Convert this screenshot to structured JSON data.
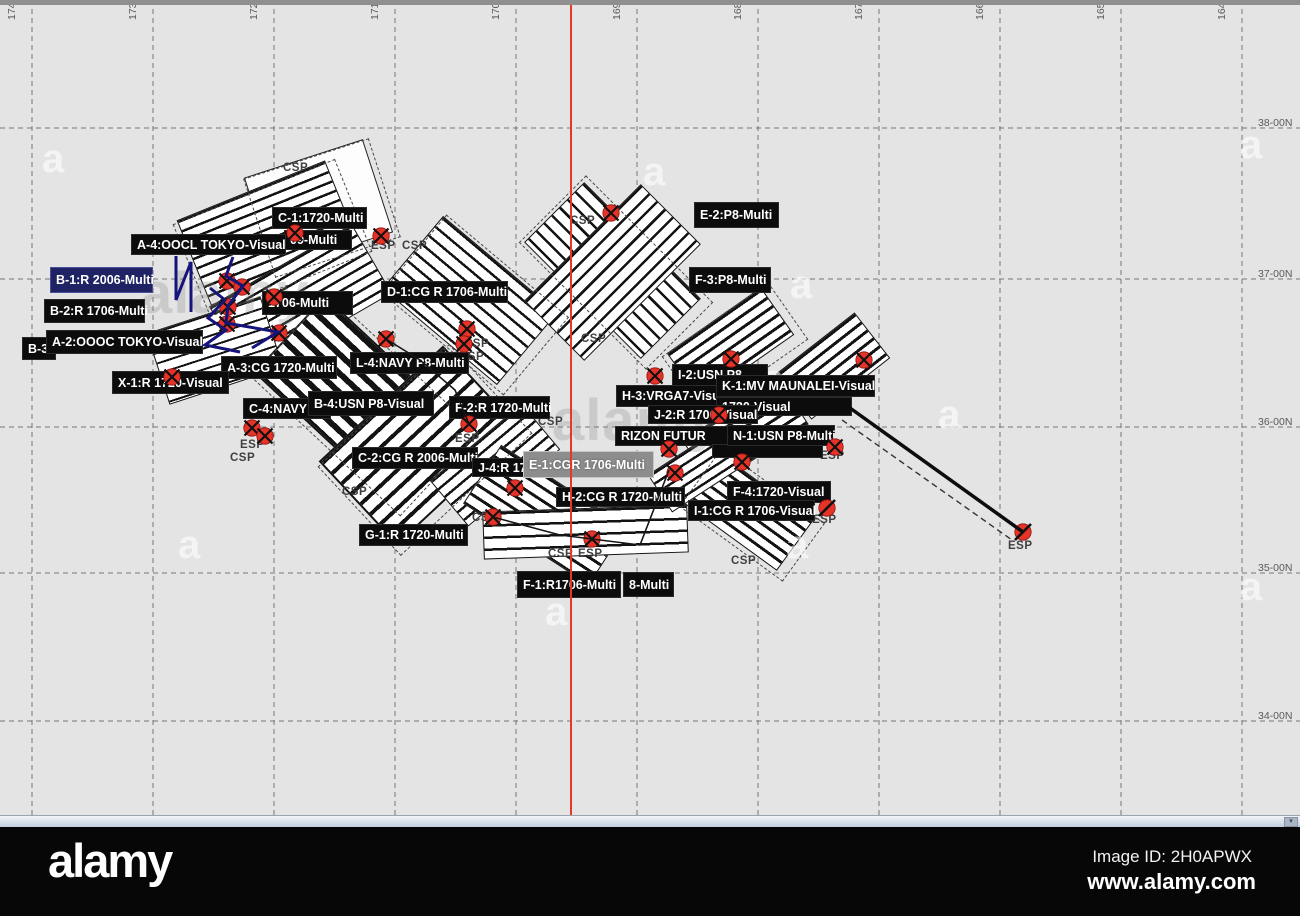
{
  "map": {
    "background": "#e4e4e4",
    "red_line_x": 570,
    "grid": {
      "lon_labels": [
        {
          "text": "174-00W",
          "x": 32
        },
        {
          "text": "173-00W",
          "x": 153
        },
        {
          "text": "172-00W",
          "x": 274
        },
        {
          "text": "171-00W",
          "x": 395
        },
        {
          "text": "170-00W",
          "x": 516
        },
        {
          "text": "169-00W",
          "x": 637
        },
        {
          "text": "168-00W",
          "x": 758
        },
        {
          "text": "167-00W",
          "x": 879
        },
        {
          "text": "166-00W",
          "x": 1000
        },
        {
          "text": "165-00W",
          "x": 1121
        },
        {
          "text": "164-00W",
          "x": 1242
        }
      ],
      "lat_labels": [
        {
          "text": "38-00N",
          "y": 133
        },
        {
          "text": "37-00N",
          "y": 284
        },
        {
          "text": "36-00N",
          "y": 432
        },
        {
          "text": "35-00N",
          "y": 578
        },
        {
          "text": "34-00N",
          "y": 726
        }
      ]
    },
    "search_area_labels": [
      {
        "text": "C-1:1720-Multi",
        "x": 272,
        "y": 207,
        "w": 95,
        "h": 22,
        "bg": "black"
      },
      {
        "text": "09-Multi",
        "x": 284,
        "y": 230,
        "w": 68,
        "h": 20,
        "bg": "black"
      },
      {
        "text": "A-4:OOCL TOKYO-Visual",
        "x": 131,
        "y": 234,
        "w": 155,
        "h": 21,
        "bg": "black"
      },
      {
        "text": "B-1:R 2006-Multi",
        "x": 50,
        "y": 267,
        "w": 103,
        "h": 26,
        "bg": "navy"
      },
      {
        "text": "B-2:R 1706-Multi",
        "x": 44,
        "y": 299,
        "w": 101,
        "h": 24,
        "bg": "black"
      },
      {
        "text": "1706-Multi",
        "x": 262,
        "y": 291,
        "w": 91,
        "h": 24,
        "bg": "black"
      },
      {
        "text": "B-3",
        "x": 22,
        "y": 337,
        "w": 34,
        "h": 23,
        "bg": "black"
      },
      {
        "text": "A-2:OOOC TOKYO-Visual",
        "x": 46,
        "y": 330,
        "w": 157,
        "h": 24,
        "bg": "black"
      },
      {
        "text": "A-3:CG 1720-Multi",
        "x": 221,
        "y": 356,
        "w": 116,
        "h": 23,
        "bg": "black"
      },
      {
        "text": "X-1:R 1720-Visual",
        "x": 112,
        "y": 371,
        "w": 117,
        "h": 23,
        "bg": "black"
      },
      {
        "text": "C-4:NAVY",
        "x": 243,
        "y": 398,
        "w": 88,
        "h": 21,
        "bg": "black"
      },
      {
        "text": "B-4:USN P8-Visual",
        "x": 308,
        "y": 391,
        "w": 126,
        "h": 25,
        "bg": "black"
      },
      {
        "text": "L-4:NAVY P8-Multi",
        "x": 350,
        "y": 352,
        "w": 119,
        "h": 22,
        "bg": "black"
      },
      {
        "text": "D-1:CG R 1706-Multi",
        "x": 381,
        "y": 281,
        "w": 127,
        "h": 22,
        "bg": "black"
      },
      {
        "text": "F-2:R 1720-Multi",
        "x": 449,
        "y": 396,
        "w": 101,
        "h": 23,
        "bg": "black"
      },
      {
        "text": "C-2:CG R 2006-Multi",
        "x": 352,
        "y": 447,
        "w": 126,
        "h": 22,
        "bg": "black"
      },
      {
        "text": "J-4:R 170",
        "x": 472,
        "y": 458,
        "w": 60,
        "h": 19,
        "bg": "black"
      },
      {
        "text": "E-1:CGR 1706-Multi",
        "x": 523,
        "y": 451,
        "w": 131,
        "h": 27,
        "bg": "gray"
      },
      {
        "text": "H-2:CG R 1720-Multi",
        "x": 556,
        "y": 487,
        "w": 129,
        "h": 20,
        "bg": "black"
      },
      {
        "text": "G-1:R 1720-Multi",
        "x": 359,
        "y": 524,
        "w": 109,
        "h": 22,
        "bg": "black"
      },
      {
        "text": "F-1:R1706-Multi",
        "x": 517,
        "y": 571,
        "w": 104,
        "h": 27,
        "bg": "black"
      },
      {
        "text": "8-Multi",
        "x": 623,
        "y": 572,
        "w": 51,
        "h": 25,
        "bg": "black"
      },
      {
        "text": "E-2:P8-Multi",
        "x": 694,
        "y": 202,
        "w": 85,
        "h": 26,
        "bg": "black"
      },
      {
        "text": "F-3:P8-Multi",
        "x": 689,
        "y": 267,
        "w": 82,
        "h": 26,
        "bg": "black"
      },
      {
        "text": "I-2:USN P8",
        "x": 672,
        "y": 364,
        "w": 96,
        "h": 22,
        "bg": "black"
      },
      {
        "text": "H-3:VRGA7-Visual",
        "x": 616,
        "y": 385,
        "w": 112,
        "h": 22,
        "bg": "black"
      },
      {
        "text": "1720-Visual",
        "x": 716,
        "y": 397,
        "w": 136,
        "h": 19,
        "bg": "black"
      },
      {
        "text": "J-2:R 1706-Visual",
        "x": 648,
        "y": 405,
        "w": 110,
        "h": 19,
        "bg": "black"
      },
      {
        "text": "K-1:MV MAUNALEI-Visual",
        "x": 716,
        "y": 375,
        "w": 159,
        "h": 22,
        "bg": "black"
      },
      {
        "text": "RIZON FUTUR",
        "x": 615,
        "y": 426,
        "w": 116,
        "h": 20,
        "bg": "black"
      },
      {
        "text": "",
        "x": 712,
        "y": 444,
        "w": 111,
        "h": 14,
        "bg": "black"
      },
      {
        "text": "N-1:USN P8-Multi",
        "x": 727,
        "y": 425,
        "w": 108,
        "h": 21,
        "bg": "black"
      },
      {
        "text": "F-4:1720-Visual",
        "x": 727,
        "y": 481,
        "w": 104,
        "h": 22,
        "bg": "black"
      },
      {
        "text": "I-1:CG R 1706-Visual",
        "x": 688,
        "y": 500,
        "w": 127,
        "h": 21,
        "bg": "black"
      }
    ],
    "sp_labels": [
      {
        "text": "CSP",
        "x": 283,
        "y": 162
      },
      {
        "text": "CSP",
        "x": 570,
        "y": 215
      },
      {
        "text": "ESP",
        "x": 371,
        "y": 240
      },
      {
        "text": "CSP",
        "x": 402,
        "y": 240
      },
      {
        "text": "CSP",
        "x": 581,
        "y": 333
      },
      {
        "text": "CSP",
        "x": 464,
        "y": 338
      },
      {
        "text": "CSP",
        "x": 459,
        "y": 351
      },
      {
        "text": "ESP",
        "x": 240,
        "y": 439
      },
      {
        "text": "CSP",
        "x": 230,
        "y": 452
      },
      {
        "text": "ESP",
        "x": 455,
        "y": 433
      },
      {
        "text": "CSP",
        "x": 538,
        "y": 416
      },
      {
        "text": "CSP",
        "x": 342,
        "y": 486
      },
      {
        "text": "CSP",
        "x": 472,
        "y": 512
      },
      {
        "text": "CSP",
        "x": 548,
        "y": 548
      },
      {
        "text": "ESP",
        "x": 578,
        "y": 548
      },
      {
        "text": "ESP",
        "x": 820,
        "y": 450
      },
      {
        "text": "ESP",
        "x": 812,
        "y": 514
      },
      {
        "text": "CSP",
        "x": 731,
        "y": 555
      },
      {
        "text": "ESP",
        "x": 1008,
        "y": 540
      }
    ],
    "waypoint_markers": [
      {
        "x": 295,
        "y": 233,
        "type": "x"
      },
      {
        "x": 381,
        "y": 236,
        "type": "x"
      },
      {
        "x": 227,
        "y": 281,
        "type": "x"
      },
      {
        "x": 242,
        "y": 287,
        "type": "x"
      },
      {
        "x": 274,
        "y": 297,
        "type": "x"
      },
      {
        "x": 228,
        "y": 307,
        "type": "x"
      },
      {
        "x": 227,
        "y": 324,
        "type": "x"
      },
      {
        "x": 279,
        "y": 333,
        "type": "x"
      },
      {
        "x": 172,
        "y": 377,
        "type": "x"
      },
      {
        "x": 252,
        "y": 428,
        "type": "x"
      },
      {
        "x": 265,
        "y": 436,
        "type": "x"
      },
      {
        "x": 386,
        "y": 339,
        "type": "x"
      },
      {
        "x": 467,
        "y": 329,
        "type": "x"
      },
      {
        "x": 464,
        "y": 344,
        "type": "x"
      },
      {
        "x": 469,
        "y": 424,
        "type": "x"
      },
      {
        "x": 515,
        "y": 488,
        "type": "x"
      },
      {
        "x": 493,
        "y": 517,
        "type": "x"
      },
      {
        "x": 592,
        "y": 539,
        "type": "x"
      },
      {
        "x": 611,
        "y": 213,
        "type": "x"
      },
      {
        "x": 655,
        "y": 376,
        "type": "x"
      },
      {
        "x": 731,
        "y": 359,
        "type": "x"
      },
      {
        "x": 864,
        "y": 360,
        "type": "x"
      },
      {
        "x": 719,
        "y": 415,
        "type": "x"
      },
      {
        "x": 669,
        "y": 449,
        "type": "x"
      },
      {
        "x": 675,
        "y": 473,
        "type": "x"
      },
      {
        "x": 742,
        "y": 462,
        "type": "x"
      },
      {
        "x": 835,
        "y": 447,
        "type": "x"
      },
      {
        "x": 827,
        "y": 508,
        "type": "slash"
      },
      {
        "x": 1023,
        "y": 532,
        "type": "slash"
      }
    ],
    "patterns": [
      {
        "cx": 268,
        "cy": 233,
        "w": 160,
        "h": 92,
        "rot": -22,
        "line": 2.5,
        "gap": 10
      },
      {
        "cx": 300,
        "cy": 300,
        "w": 165,
        "h": 80,
        "rot": -30,
        "line": 2.5,
        "gap": 10
      },
      {
        "cx": 215,
        "cy": 350,
        "w": 120,
        "h": 75,
        "rot": -18,
        "line": 2,
        "gap": 10
      },
      {
        "cx": 470,
        "cy": 300,
        "w": 150,
        "h": 95,
        "rot": 40,
        "line": 2.5,
        "gap": 11
      },
      {
        "cx": 360,
        "cy": 400,
        "w": 195,
        "h": 105,
        "rot": 43,
        "line": 6,
        "gap": 14
      },
      {
        "cx": 420,
        "cy": 445,
        "w": 170,
        "h": 115,
        "rot": -43,
        "line": 4,
        "gap": 14
      },
      {
        "cx": 495,
        "cy": 465,
        "w": 120,
        "h": 60,
        "rot": -40,
        "line": 2.5,
        "gap": 10
      },
      {
        "cx": 545,
        "cy": 515,
        "w": 150,
        "h": 70,
        "rot": 33,
        "line": 3,
        "gap": 11
      },
      {
        "cx": 585,
        "cy": 532,
        "w": 205,
        "h": 48,
        "rot": -2,
        "line": 2.5,
        "gap": 12
      },
      {
        "cx": 612,
        "cy": 270,
        "w": 165,
        "h": 85,
        "rot": 45,
        "line": 2.5,
        "gap": 11
      },
      {
        "cx": 612,
        "cy": 272,
        "w": 165,
        "h": 85,
        "rot": -45,
        "line": 2.5,
        "gap": 11
      },
      {
        "cx": 730,
        "cy": 344,
        "w": 115,
        "h": 58,
        "rot": -35,
        "line": 3,
        "gap": 10
      },
      {
        "cx": 833,
        "cy": 366,
        "w": 100,
        "h": 58,
        "rot": -38,
        "line": 3,
        "gap": 10
      },
      {
        "cx": 745,
        "cy": 432,
        "w": 115,
        "h": 55,
        "rot": -33,
        "line": 3,
        "gap": 10
      },
      {
        "cx": 748,
        "cy": 512,
        "w": 115,
        "h": 62,
        "rot": 36,
        "line": 3,
        "gap": 10
      },
      {
        "cx": 695,
        "cy": 470,
        "w": 85,
        "h": 45,
        "rot": -33,
        "line": 2.5,
        "gap": 9
      }
    ],
    "dashed_boxes": [
      {
        "cx": 272,
        "cy": 238,
        "w": 175,
        "h": 100,
        "rot": -22
      },
      {
        "cx": 475,
        "cy": 305,
        "w": 160,
        "h": 102,
        "rot": 40
      },
      {
        "cx": 425,
        "cy": 450,
        "w": 180,
        "h": 122,
        "rot": -43
      },
      {
        "cx": 735,
        "cy": 348,
        "w": 130,
        "h": 70,
        "rot": -35
      },
      {
        "cx": 752,
        "cy": 515,
        "w": 128,
        "h": 72,
        "rot": 36
      },
      {
        "cx": 616,
        "cy": 272,
        "w": 180,
        "h": 95,
        "rot": 45
      },
      {
        "cx": 364,
        "cy": 404,
        "w": 205,
        "h": 115,
        "rot": 43
      },
      {
        "cx": 322,
        "cy": 208,
        "w": 132,
        "h": 104,
        "rot": -18
      }
    ],
    "empty_quad": {
      "cx": 318,
      "cy": 205,
      "w": 125,
      "h": 98,
      "rot": -18
    },
    "tracks": {
      "navy_color": "#14147a",
      "navy_polylines": [
        "233,257 226,276 243,286 228,306 226,323 278,332 252,348",
        "210,288 225,300 208,318 226,330 205,345 240,352",
        "176,256 176,300 191,262 191,312"
      ],
      "black_polylines": [
        "493,517 560,535 592,539 640,545 669,470",
        "386,339 420,360 455,390 469,424"
      ],
      "diagonal_solid": {
        "x1": 850,
        "y1": 408,
        "x2": 1023,
        "y2": 532
      },
      "diagonal_dashed": {
        "x1": 842,
        "y1": 420,
        "x2": 1012,
        "y2": 540
      }
    },
    "watermarks": {
      "brand_texts": [
        {
          "text": "alamy",
          "x": 140,
          "y": 255
        },
        {
          "text": "alamy",
          "x": 552,
          "y": 382
        }
      ],
      "a_glyphs": [
        {
          "x": 42,
          "y": 132
        },
        {
          "x": 643,
          "y": 145
        },
        {
          "x": 790,
          "y": 258
        },
        {
          "x": 938,
          "y": 388
        },
        {
          "x": 178,
          "y": 518
        },
        {
          "x": 786,
          "y": 518
        },
        {
          "x": 1240,
          "y": 118
        },
        {
          "x": 545,
          "y": 585
        },
        {
          "x": 762,
          "y": 352
        },
        {
          "x": 1240,
          "y": 560
        }
      ]
    }
  },
  "scrollbar": {
    "button_glyph": "▾"
  },
  "footer": {
    "brand": "alamy",
    "image_id": "Image ID: 2H0APWX",
    "url": "www.alamy.com"
  }
}
